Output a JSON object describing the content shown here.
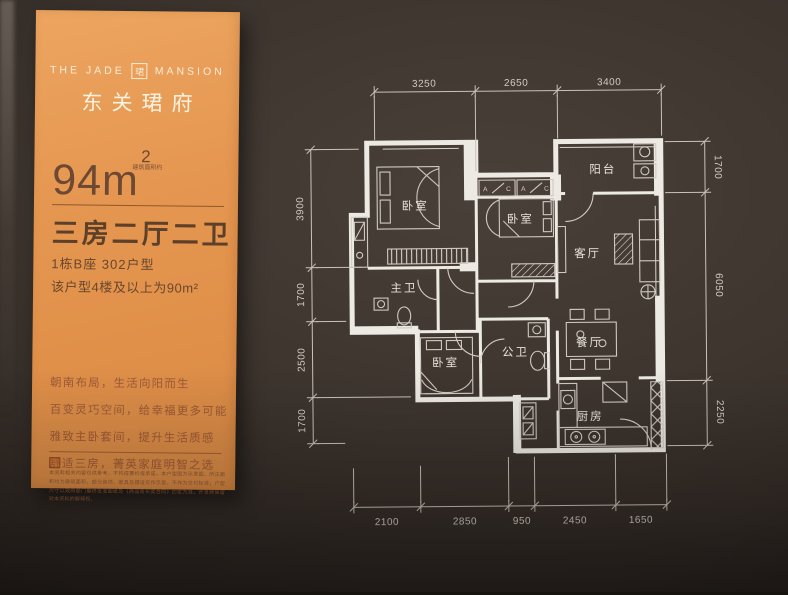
{
  "panel": {
    "brand_en_left": "THE JADE",
    "brand_logo_char": "珺",
    "brand_en_right": "MANSION",
    "brand_cn": "东关珺府",
    "area_value": "94m",
    "area_sup": "2",
    "area_note": "建筑面积约",
    "layout_title": "三房二厅二卫",
    "unit_line1": "1栋B座  302户型",
    "unit_line2": "该户型4楼及以上为90m²",
    "slogans": [
      "朝南布局，生活向阳而生",
      "百变灵巧空间，给幸福更多可能",
      "雅致主卧套间，提升生活质感",
      "舒适三房，菁英家庭明智之选"
    ],
    "disclaimer": "本资料相关内容仅供参考，不构成要约或承诺。本户型图为示意图，所注面积均为建筑面积，部分装饰、家具及摆设仅作示意，不作为交付标准；户型尺寸以政府部门最终批准图纸及《商品房买卖合同》约定为准，开发商保留对本资料的解释权。"
  },
  "floorplan": {
    "rooms": [
      {
        "id": "bedroom-1",
        "label": "卧室"
      },
      {
        "id": "bedroom-2",
        "label": "卧室"
      },
      {
        "id": "balcony",
        "label": "阳台"
      },
      {
        "id": "living-room",
        "label": "客厅"
      },
      {
        "id": "master-bath",
        "label": "主卫"
      },
      {
        "id": "bedroom-3",
        "label": "卧室"
      },
      {
        "id": "public-bath",
        "label": "公卫"
      },
      {
        "id": "dining-room",
        "label": "餐厅"
      },
      {
        "id": "kitchen",
        "label": "厨房"
      }
    ],
    "closet_marks": [
      "A",
      "C",
      "A",
      "C"
    ],
    "dims": {
      "top": [
        "3250",
        "2650",
        "3400"
      ],
      "bottom": [
        "2100",
        "2850",
        "950",
        "2450",
        "1650"
      ],
      "left": [
        "3900",
        "1700",
        "2500",
        "1700"
      ],
      "right": [
        "1700",
        "6050",
        "2250"
      ]
    }
  },
  "colors": {
    "board_bg": "#3a312b",
    "panel_orange": "#e2934e",
    "plan_line": "#e9e5de",
    "panel_text_light": "#f7ecd9",
    "panel_text_dark": "#5d4029",
    "slogan_text": "#9e5a36"
  }
}
